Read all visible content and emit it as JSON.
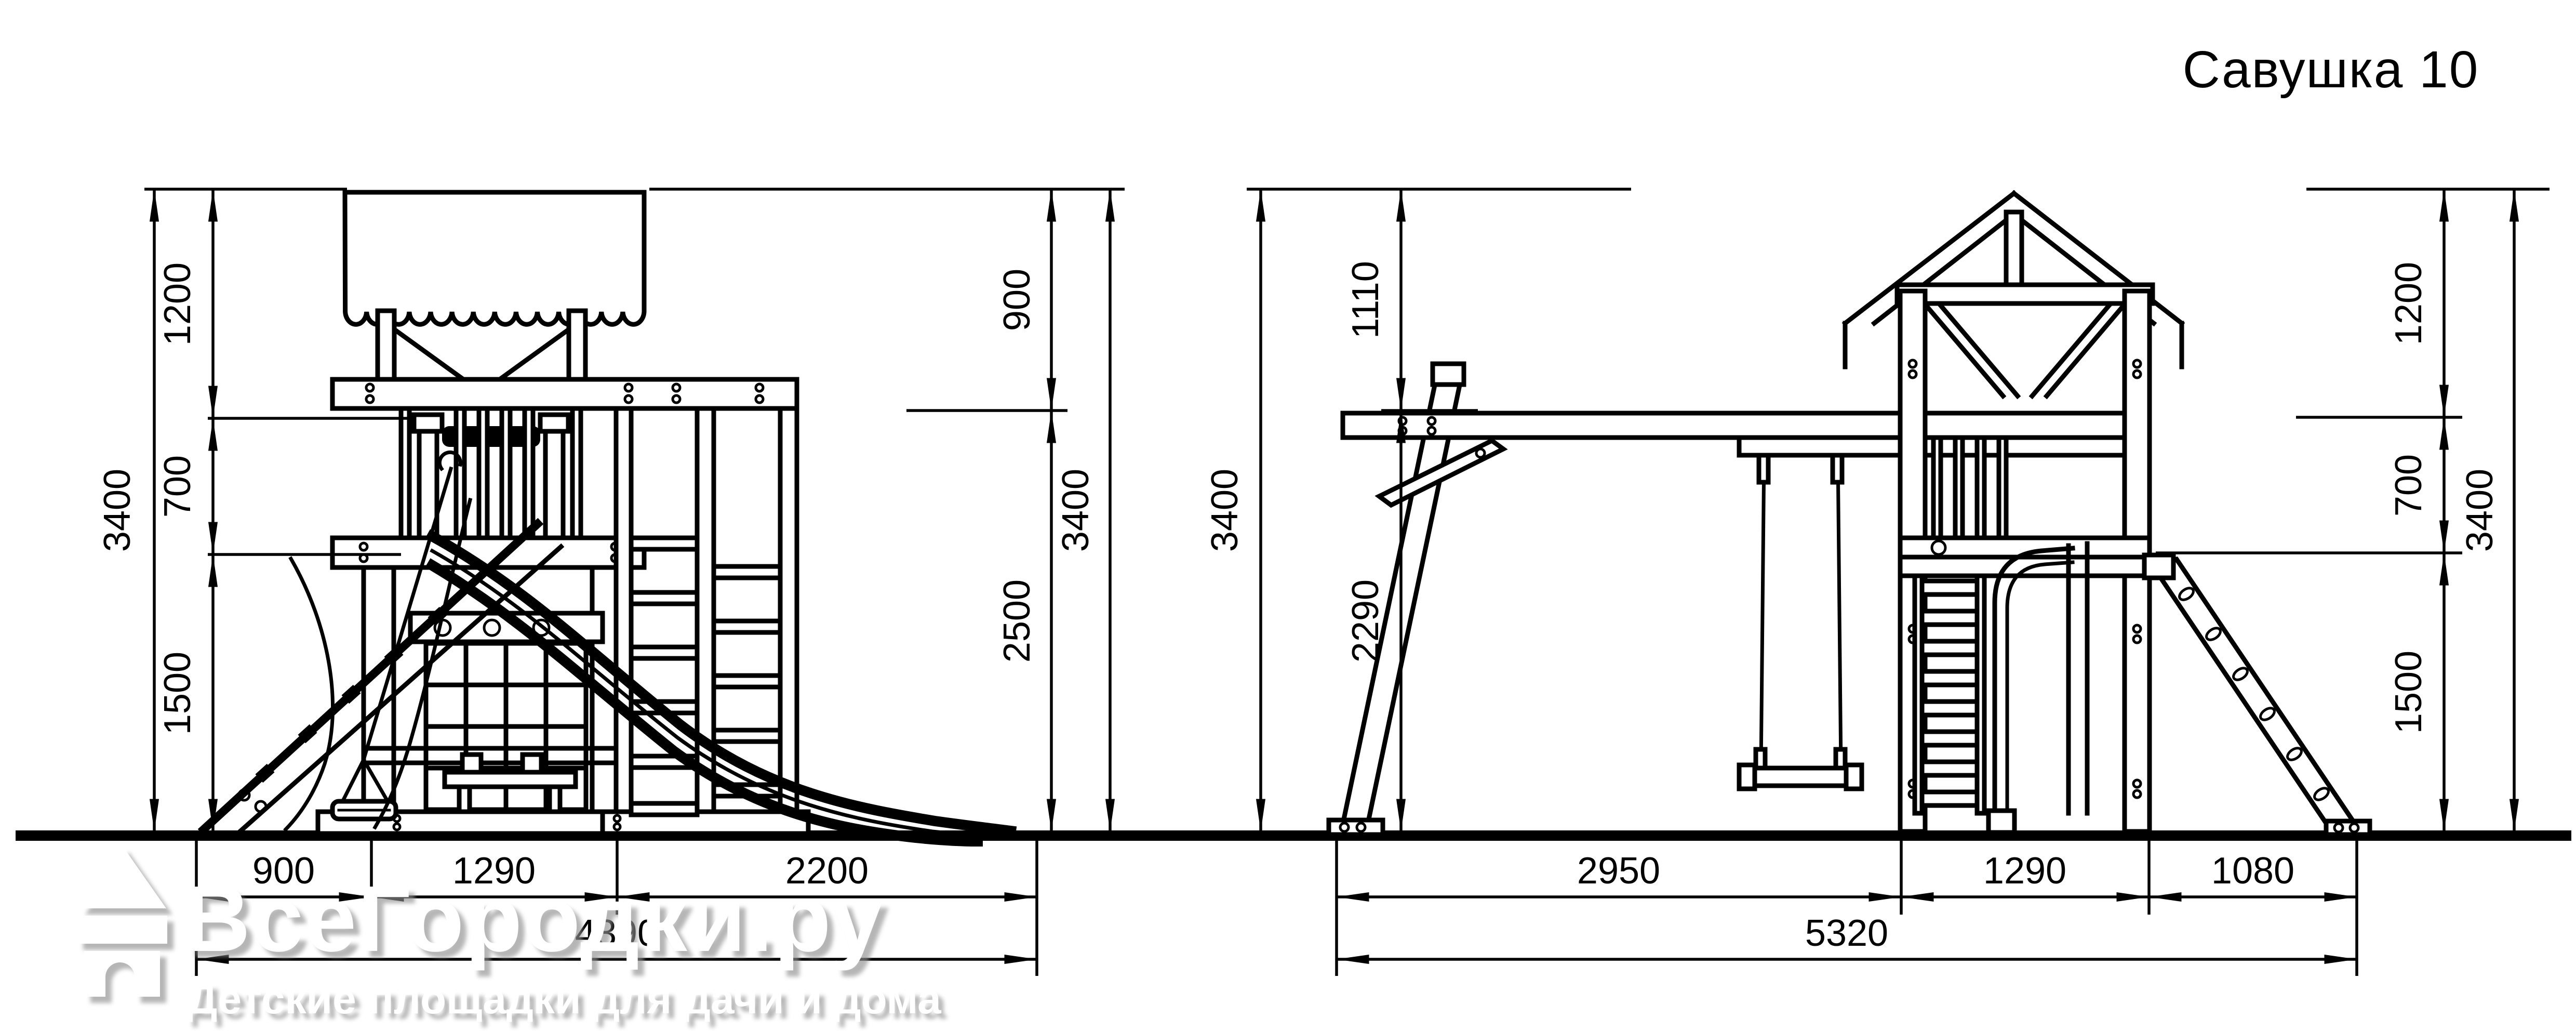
{
  "title": "Савушка 10",
  "watermark": {
    "brand": "ВсеГородки.ру",
    "tagline": "Детские площадки для дачи и дома",
    "logo_icon": "house-icon"
  },
  "colors": {
    "line": "#000000",
    "background": "#ffffff",
    "watermark_text": "#ffffff",
    "watermark_shadow": "#8f8f8f"
  },
  "views": {
    "front": {
      "dims": {
        "left_outer": "3400",
        "left_chain": [
          "1200",
          "700",
          "1500"
        ],
        "right_chain": [
          "900",
          "2500"
        ],
        "right_outer": "3400",
        "bottom_chain": [
          "900",
          "1290",
          "2200"
        ],
        "bottom_total": "4390"
      }
    },
    "side": {
      "dims": {
        "left_outer": "3400",
        "left_chain": [
          "1110",
          "2290"
        ],
        "right_chain": [
          "1200",
          "700",
          "1500"
        ],
        "right_outer": "3400",
        "bottom_chain": [
          "2950",
          "1290",
          "1080"
        ],
        "bottom_total": "5320"
      }
    }
  }
}
